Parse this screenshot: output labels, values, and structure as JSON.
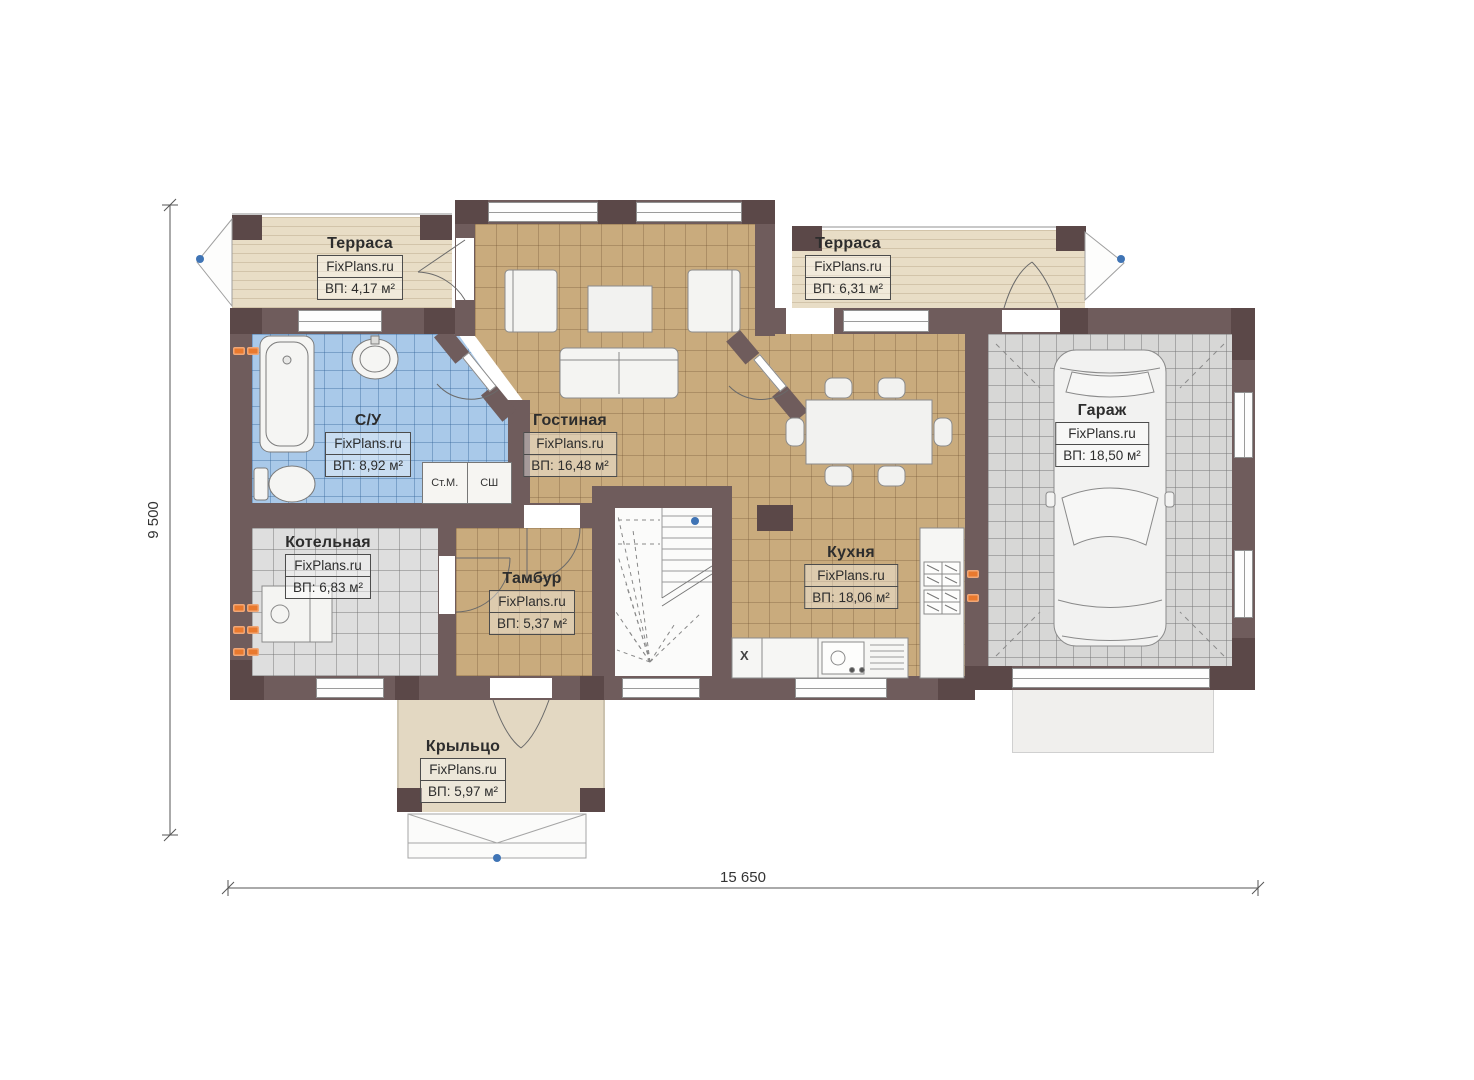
{
  "rooms": {
    "terrace_left": {
      "name": "Терраса",
      "brand": "FixPlans.ru",
      "area": "ВП: 4,17 м²"
    },
    "living": {
      "name": "Гостиная",
      "brand": "FixPlans.ru",
      "area": "ВП: 16,48 м²"
    },
    "terrace_right": {
      "name": "Терраса",
      "brand": "FixPlans.ru",
      "area": "ВП: 6,31 м²"
    },
    "bathroom": {
      "name": "С/У",
      "brand": "FixPlans.ru",
      "area": "ВП: 8,92 м²"
    },
    "boiler": {
      "name": "Котельная",
      "brand": "FixPlans.ru",
      "area": "ВП: 6,83 м²"
    },
    "tambour": {
      "name": "Тамбур",
      "brand": "FixPlans.ru",
      "area": "ВП: 5,37 м²"
    },
    "kitchen": {
      "name": "Кухня",
      "brand": "FixPlans.ru",
      "area": "ВП: 18,06 м²"
    },
    "garage": {
      "name": "Гараж",
      "brand": "FixPlans.ru",
      "area": "ВП: 18,50 м²"
    },
    "porch": {
      "name": "Крыльцо",
      "brand": "FixPlans.ru",
      "area": "ВП: 5,97 м²"
    }
  },
  "appliances": {
    "washer": "Ст.М.",
    "dryer": "СШ",
    "x_unit": "X"
  },
  "dimensions": {
    "height": "9 500",
    "width": "15 650"
  },
  "colors": {
    "wall": "#6f5c5c",
    "pier": "#5b4848",
    "tile_tan": "#c9ab7d",
    "tile_blue": "#a9c9e9",
    "tile_gray": "#dedede",
    "terrace": "#e8ddc6",
    "radiator": "#e9792e",
    "marker_blue": "#3f74b5"
  }
}
